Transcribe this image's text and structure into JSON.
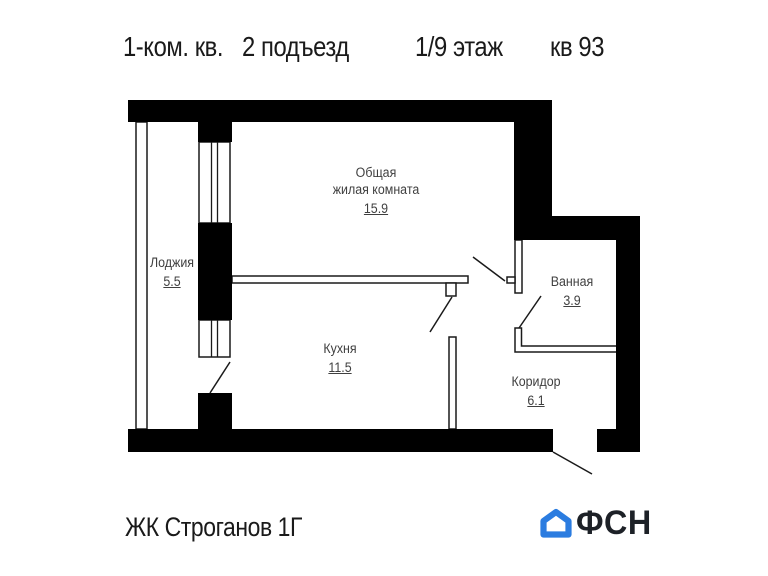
{
  "header": {
    "apartment_type": "1-ком. кв.",
    "entrance": "2 подъезд",
    "floor": "1/9 этаж",
    "unit": "кв 93"
  },
  "plan": {
    "rooms": {
      "loggia": {
        "name": "Лоджия",
        "area": "5.5"
      },
      "living": {
        "name_line1": "Общая",
        "name_line2": "жилая комната",
        "area": "15.9"
      },
      "kitchen": {
        "name": "Кухня",
        "area": "11.5"
      },
      "bathroom": {
        "name": "Ванная",
        "area": "3.9"
      },
      "corridor": {
        "name": "Коридор",
        "area": "6.1"
      }
    }
  },
  "footer": {
    "complex_name": "ЖК Строганов 1Г",
    "brand": "ФСН"
  },
  "icons": {
    "logo_house": "house-icon"
  },
  "colors": {
    "logo_blue": "#2b7ce0",
    "brand_text": "#1d2127",
    "wall": "#000000",
    "line": "#1a1a1a",
    "label": "#3f3f3f"
  }
}
